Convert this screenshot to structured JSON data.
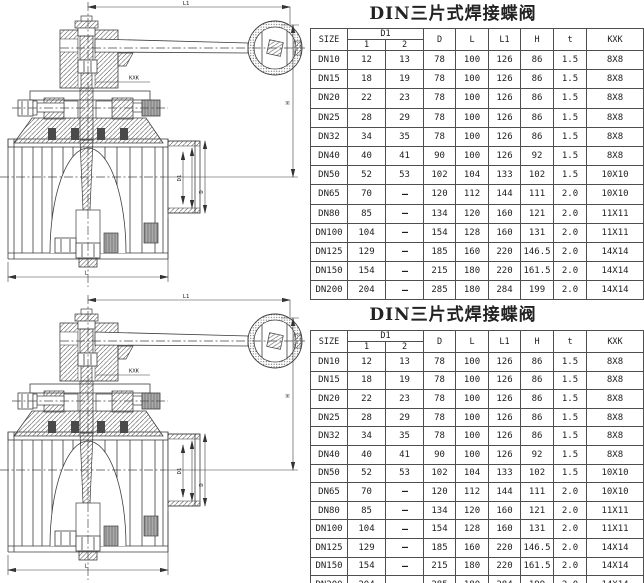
{
  "sections": [
    {
      "title": "DIN三片式焊接蝶阀",
      "drawing_dims": {
        "l1": "L1",
        "kxk": "KXK",
        "h": "H",
        "d1": "D1",
        "d": "D",
        "l": "L"
      },
      "table": {
        "headers": {
          "size": "SIZE",
          "d1": "D1",
          "d1_sub": [
            "1",
            "2"
          ],
          "cols": [
            "D",
            "L",
            "L1",
            "H",
            "t",
            "KXK"
          ]
        },
        "rows": [
          [
            "DN10",
            "12",
            "13",
            "78",
            "100",
            "126",
            "86",
            "1.5",
            "8X8"
          ],
          [
            "DN15",
            "18",
            "19",
            "78",
            "100",
            "126",
            "86",
            "1.5",
            "8X8"
          ],
          [
            "DN20",
            "22",
            "23",
            "78",
            "100",
            "126",
            "86",
            "1.5",
            "8X8"
          ],
          [
            "DN25",
            "28",
            "29",
            "78",
            "100",
            "126",
            "86",
            "1.5",
            "8X8"
          ],
          [
            "DN32",
            "34",
            "35",
            "78",
            "100",
            "126",
            "86",
            "1.5",
            "8X8"
          ],
          [
            "DN40",
            "40",
            "41",
            "90",
            "100",
            "126",
            "92",
            "1.5",
            "8X8"
          ],
          [
            "DN50",
            "52",
            "53",
            "102",
            "104",
            "133",
            "102",
            "1.5",
            "10X10"
          ],
          [
            "DN65",
            "70",
            "—",
            "120",
            "112",
            "144",
            "111",
            "2.0",
            "10X10"
          ],
          [
            "DN80",
            "85",
            "—",
            "134",
            "120",
            "160",
            "121",
            "2.0",
            "11X11"
          ],
          [
            "DN100",
            "104",
            "—",
            "154",
            "128",
            "160",
            "131",
            "2.0",
            "11X11"
          ],
          [
            "DN125",
            "129",
            "—",
            "185",
            "160",
            "220",
            "146.5",
            "2.0",
            "14X14"
          ],
          [
            "DN150",
            "154",
            "—",
            "215",
            "180",
            "220",
            "161.5",
            "2.0",
            "14X14"
          ],
          [
            "DN200",
            "204",
            "—",
            "285",
            "180",
            "284",
            "199",
            "2.0",
            "14X14"
          ]
        ]
      }
    },
    {
      "title": "DIN三片式焊接蝶阀",
      "drawing_dims": {
        "l1": "L1",
        "kxk": "KXK",
        "h": "H",
        "d1": "D1",
        "d": "D",
        "l": "L"
      },
      "table": {
        "headers": {
          "size": "SIZE",
          "d1": "D1",
          "d1_sub": [
            "1",
            "2"
          ],
          "cols": [
            "D",
            "L",
            "L1",
            "H",
            "t",
            "KXK"
          ]
        },
        "rows": [
          [
            "DN10",
            "12",
            "13",
            "78",
            "100",
            "126",
            "86",
            "1.5",
            "8X8"
          ],
          [
            "DN15",
            "18",
            "19",
            "78",
            "100",
            "126",
            "86",
            "1.5",
            "8X8"
          ],
          [
            "DN20",
            "22",
            "23",
            "78",
            "100",
            "126",
            "86",
            "1.5",
            "8X8"
          ],
          [
            "DN25",
            "28",
            "29",
            "78",
            "100",
            "126",
            "86",
            "1.5",
            "8X8"
          ],
          [
            "DN32",
            "34",
            "35",
            "78",
            "100",
            "126",
            "86",
            "1.5",
            "8X8"
          ],
          [
            "DN40",
            "40",
            "41",
            "90",
            "100",
            "126",
            "92",
            "1.5",
            "8X8"
          ],
          [
            "DN50",
            "52",
            "53",
            "102",
            "104",
            "133",
            "102",
            "1.5",
            "10X10"
          ],
          [
            "DN65",
            "70",
            "—",
            "120",
            "112",
            "144",
            "111",
            "2.0",
            "10X10"
          ],
          [
            "DN80",
            "85",
            "—",
            "134",
            "120",
            "160",
            "121",
            "2.0",
            "11X11"
          ],
          [
            "DN100",
            "104",
            "—",
            "154",
            "128",
            "160",
            "131",
            "2.0",
            "11X11"
          ],
          [
            "DN125",
            "129",
            "—",
            "185",
            "160",
            "220",
            "146.5",
            "2.0",
            "14X14"
          ],
          [
            "DN150",
            "154",
            "—",
            "215",
            "180",
            "220",
            "161.5",
            "2.0",
            "14X14"
          ],
          [
            "DN200",
            "204",
            "—",
            "285",
            "180",
            "284",
            "199",
            "2.0",
            "14X14"
          ]
        ]
      }
    }
  ]
}
